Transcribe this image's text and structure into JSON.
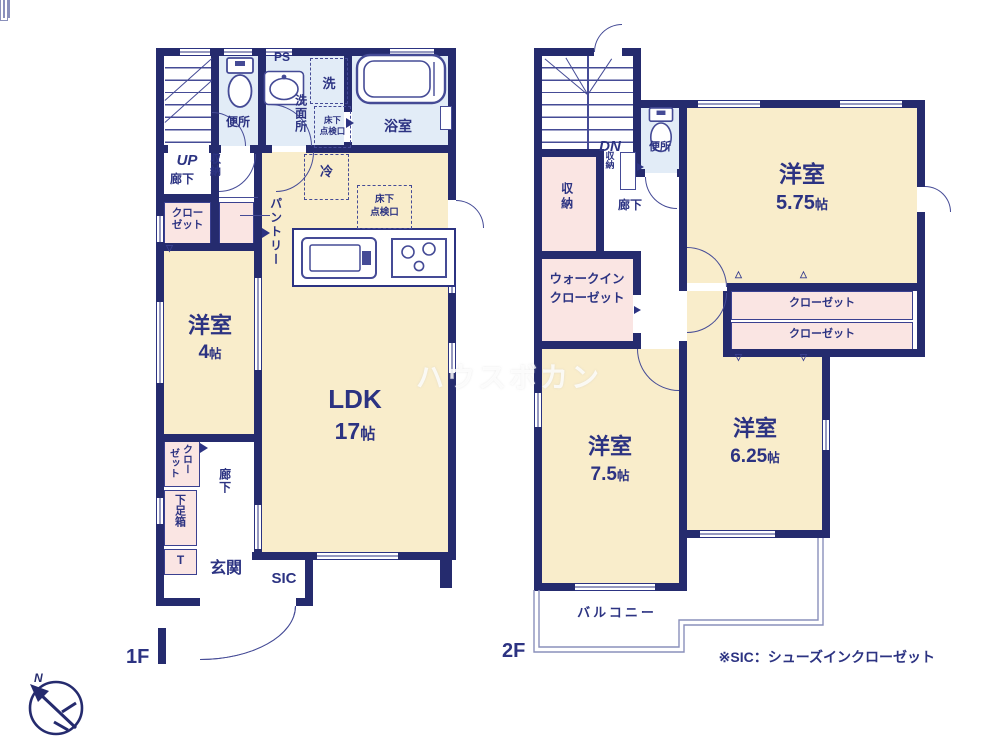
{
  "watermark": "ハウスボカン",
  "note": "※SIC：シューズインクローゼット",
  "compass": {
    "north": "N"
  },
  "palette": {
    "wall": "#252b6e",
    "text": "#2c3382",
    "room_cream": "#f9edcb",
    "room_pink": "#fae5e3",
    "room_blue": "#e2ecf7",
    "outline_light": "#8a90bb"
  },
  "floor1": {
    "floor_label": "1F",
    "stair_direction": "UP",
    "hallway_upper": "廊下",
    "toilet": "便所",
    "pipe_space": "PS",
    "washer": "洗",
    "washroom": "洗面所",
    "underfloor_hatch": [
      "床下",
      "点検口"
    ],
    "bath": "浴室",
    "storage": "収納",
    "closet_upper": [
      "クロー",
      "ゼット"
    ],
    "pantry": "パントリー",
    "fridge": "冷",
    "underfloor_hatch_ldk": [
      "床下",
      "点検口"
    ],
    "western_room": {
      "name": "洋室",
      "size_num": "4",
      "size_unit": "帖"
    },
    "ldk": {
      "name": "LDK",
      "size_num": "17",
      "size_unit": "帖"
    },
    "hallway_lower": "廊下",
    "closet_lower": [
      "クロー",
      "ゼット"
    ],
    "shoe_box": "下足箱",
    "shoe_box_tag": "T",
    "entrance": "玄関",
    "sic": "SIC"
  },
  "floor2": {
    "floor_label": "2F",
    "stair_direction": "DN",
    "hall_storage": "収納",
    "toilet": "便所",
    "hallway": "廊下",
    "storage": "収納",
    "walk_in_closet": [
      "ウォークイン",
      "クローゼット"
    ],
    "room_575": {
      "name": "洋室",
      "size_num": "5.75",
      "size_unit": "帖"
    },
    "closet_1": "クローゼット",
    "closet_2": "クローゼット",
    "room_75": {
      "name": "洋室",
      "size_num": "7.5",
      "size_unit": "帖"
    },
    "room_625": {
      "name": "洋室",
      "size_num": "6.25",
      "size_unit": "帖"
    },
    "balcony": "バルコニー"
  }
}
